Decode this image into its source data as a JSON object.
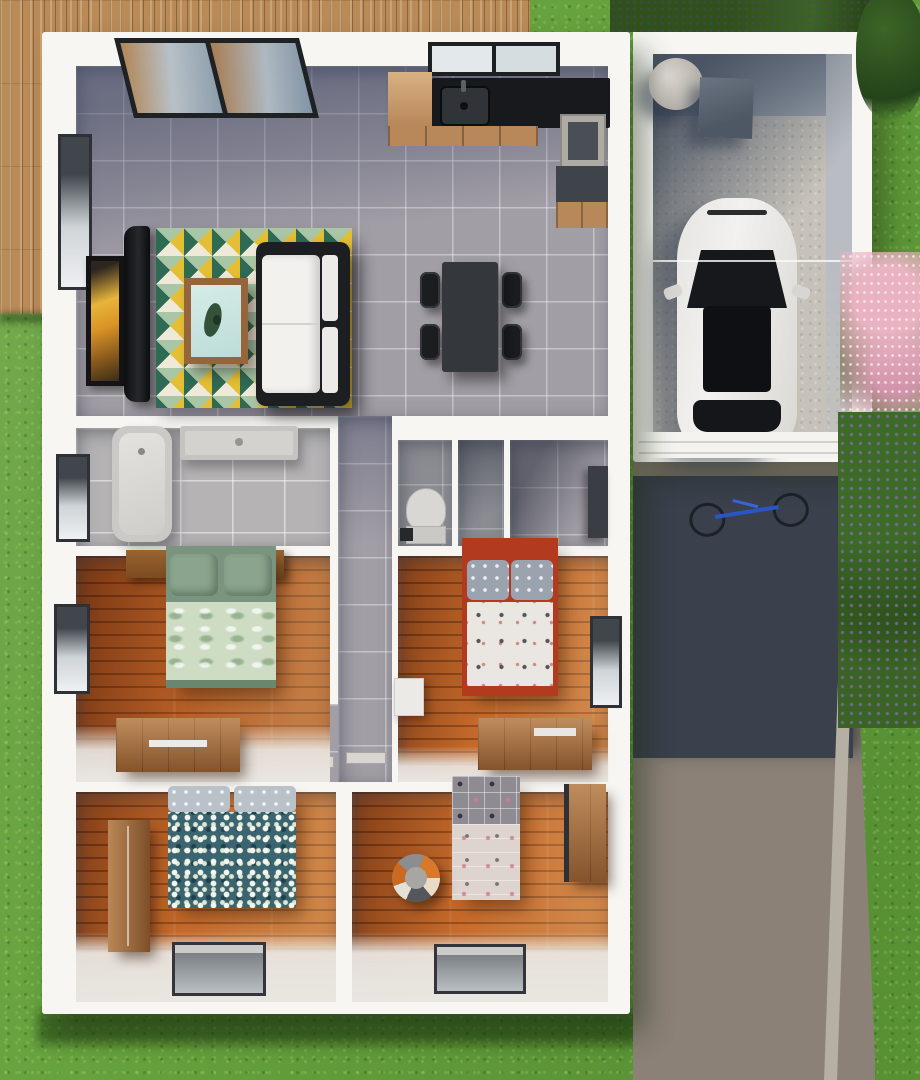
{
  "scene": {
    "title": "Top-down 3D rendered floor plan of a three/four-bedroom house with attached garage",
    "style": "photorealistic architectural render",
    "view": "overhead"
  },
  "palette": {
    "grass1": "#66a23d",
    "deck": "#b98b59",
    "wallWhite": "#f7f6f3",
    "tile": "#a29ea6",
    "tileLight": "#b5b3b4",
    "tileDark": "#8b8c92",
    "wood1": "#a8511f",
    "wood2": "#bc6026",
    "floorLight": "#e9e6e1",
    "concrete": "#c6c2b9",
    "driveDark": "#3a404c",
    "driveLight": "#8b8177",
    "curb": "#b6afa3",
    "carWhite": "#f2f1ef",
    "glassDark": "#16181c",
    "counterBlack": "#17191c",
    "cabinetWood": "#b8875a",
    "applGray": "#aeaba4",
    "tableDark": "#34373b",
    "rugYellow": "#e4bf36",
    "rugTeal": "#2f6a55",
    "rugSage": "#a9c7a6",
    "rugCream": "#efe9d7",
    "tub": "#cbc9c6",
    "toilet": "#d9d7d3",
    "bedGreenDark": "#7b947f",
    "bedGreenLight": "#cedcc4",
    "bedRed": "#b23a1f",
    "pillowGray": "#9aa3ae",
    "duvetWhite": "#eae7e2",
    "bedTeal": "#3a6470",
    "bedPinkLow": "#ddd4cf",
    "ballOrange": "#d8782a"
  },
  "rooms": [
    {
      "id": "living-area",
      "name": "Open-plan living, dining and kitchen area",
      "floor": "grey ceramic tile",
      "furniture": [
        "sliding glass patio door",
        "frosted kitchen window",
        "tall side window",
        "framed abstract artwork",
        "flat-screen television",
        "geometric triangle-pattern rug",
        "wooden coffee table with glass top and plant",
        "white sofa with dark frame",
        "black kitchen countertop with inset sink and faucet",
        "timber base cabinets",
        "tall grey appliance",
        "dark side counter with timber cabinet",
        "rectangular dining table",
        "four black dining chairs"
      ]
    },
    {
      "id": "bathroom",
      "name": "Bathroom",
      "floor": "grey tile",
      "furniture": [
        "bathtub",
        "long vanity basin",
        "side window"
      ]
    },
    {
      "id": "wc",
      "name": "Toilet room",
      "floor": "dark grey tile",
      "furniture": [
        "toilet",
        "waste bin"
      ]
    },
    {
      "id": "storage",
      "name": "Storage closet",
      "floor": "dark grey tile",
      "furniture": []
    },
    {
      "id": "entry-hall",
      "name": "Entry hall",
      "floor": "grey tile",
      "furniture": [
        "dark storage cabinet"
      ]
    },
    {
      "id": "hallway",
      "name": "Hallway",
      "floor": "grey tile",
      "furniture": [
        "door threshold strips"
      ]
    },
    {
      "id": "bedroom-master",
      "name": "Master bedroom",
      "floor": "timber planks",
      "furniture": [
        "double bed with green leaf-print bedding",
        "two timber bedside cabinets",
        "side window",
        "timber dresser"
      ]
    },
    {
      "id": "bedroom-2",
      "name": "Bedroom with red-frame bed",
      "floor": "timber planks",
      "furniture": [
        "double bed with red frame and floral duvet",
        "grey patterned pillows",
        "white cabinet",
        "timber dresser with tray",
        "side window"
      ]
    },
    {
      "id": "bedroom-3",
      "name": "Bedroom with blue floral bed",
      "floor": "timber planks",
      "furniture": [
        "double bed with teal blossom-print duvet",
        "tall timber wardrobe",
        "bottom-wall window"
      ]
    },
    {
      "id": "bedroom-4",
      "name": "Kids bedroom",
      "floor": "timber planks",
      "furniture": [
        "single bed with pink patterned bedding",
        "striped beach ball",
        "timber desk",
        "bottom-wall window"
      ]
    }
  ],
  "garage": {
    "name": "Garage",
    "floor": "concrete",
    "contents": [
      "white car seen from above",
      "cylindrical water tank",
      "grey utility unit",
      "white roller gate"
    ]
  },
  "exterior": {
    "features": [
      "timber deck along top-left",
      "lawn",
      "asphalt driveway in shadow",
      "blue bicycle lying on driveway",
      "concrete curb strip",
      "pink flowering shrub",
      "green shrub with purple flowers",
      "dark hedge along top edge"
    ]
  }
}
